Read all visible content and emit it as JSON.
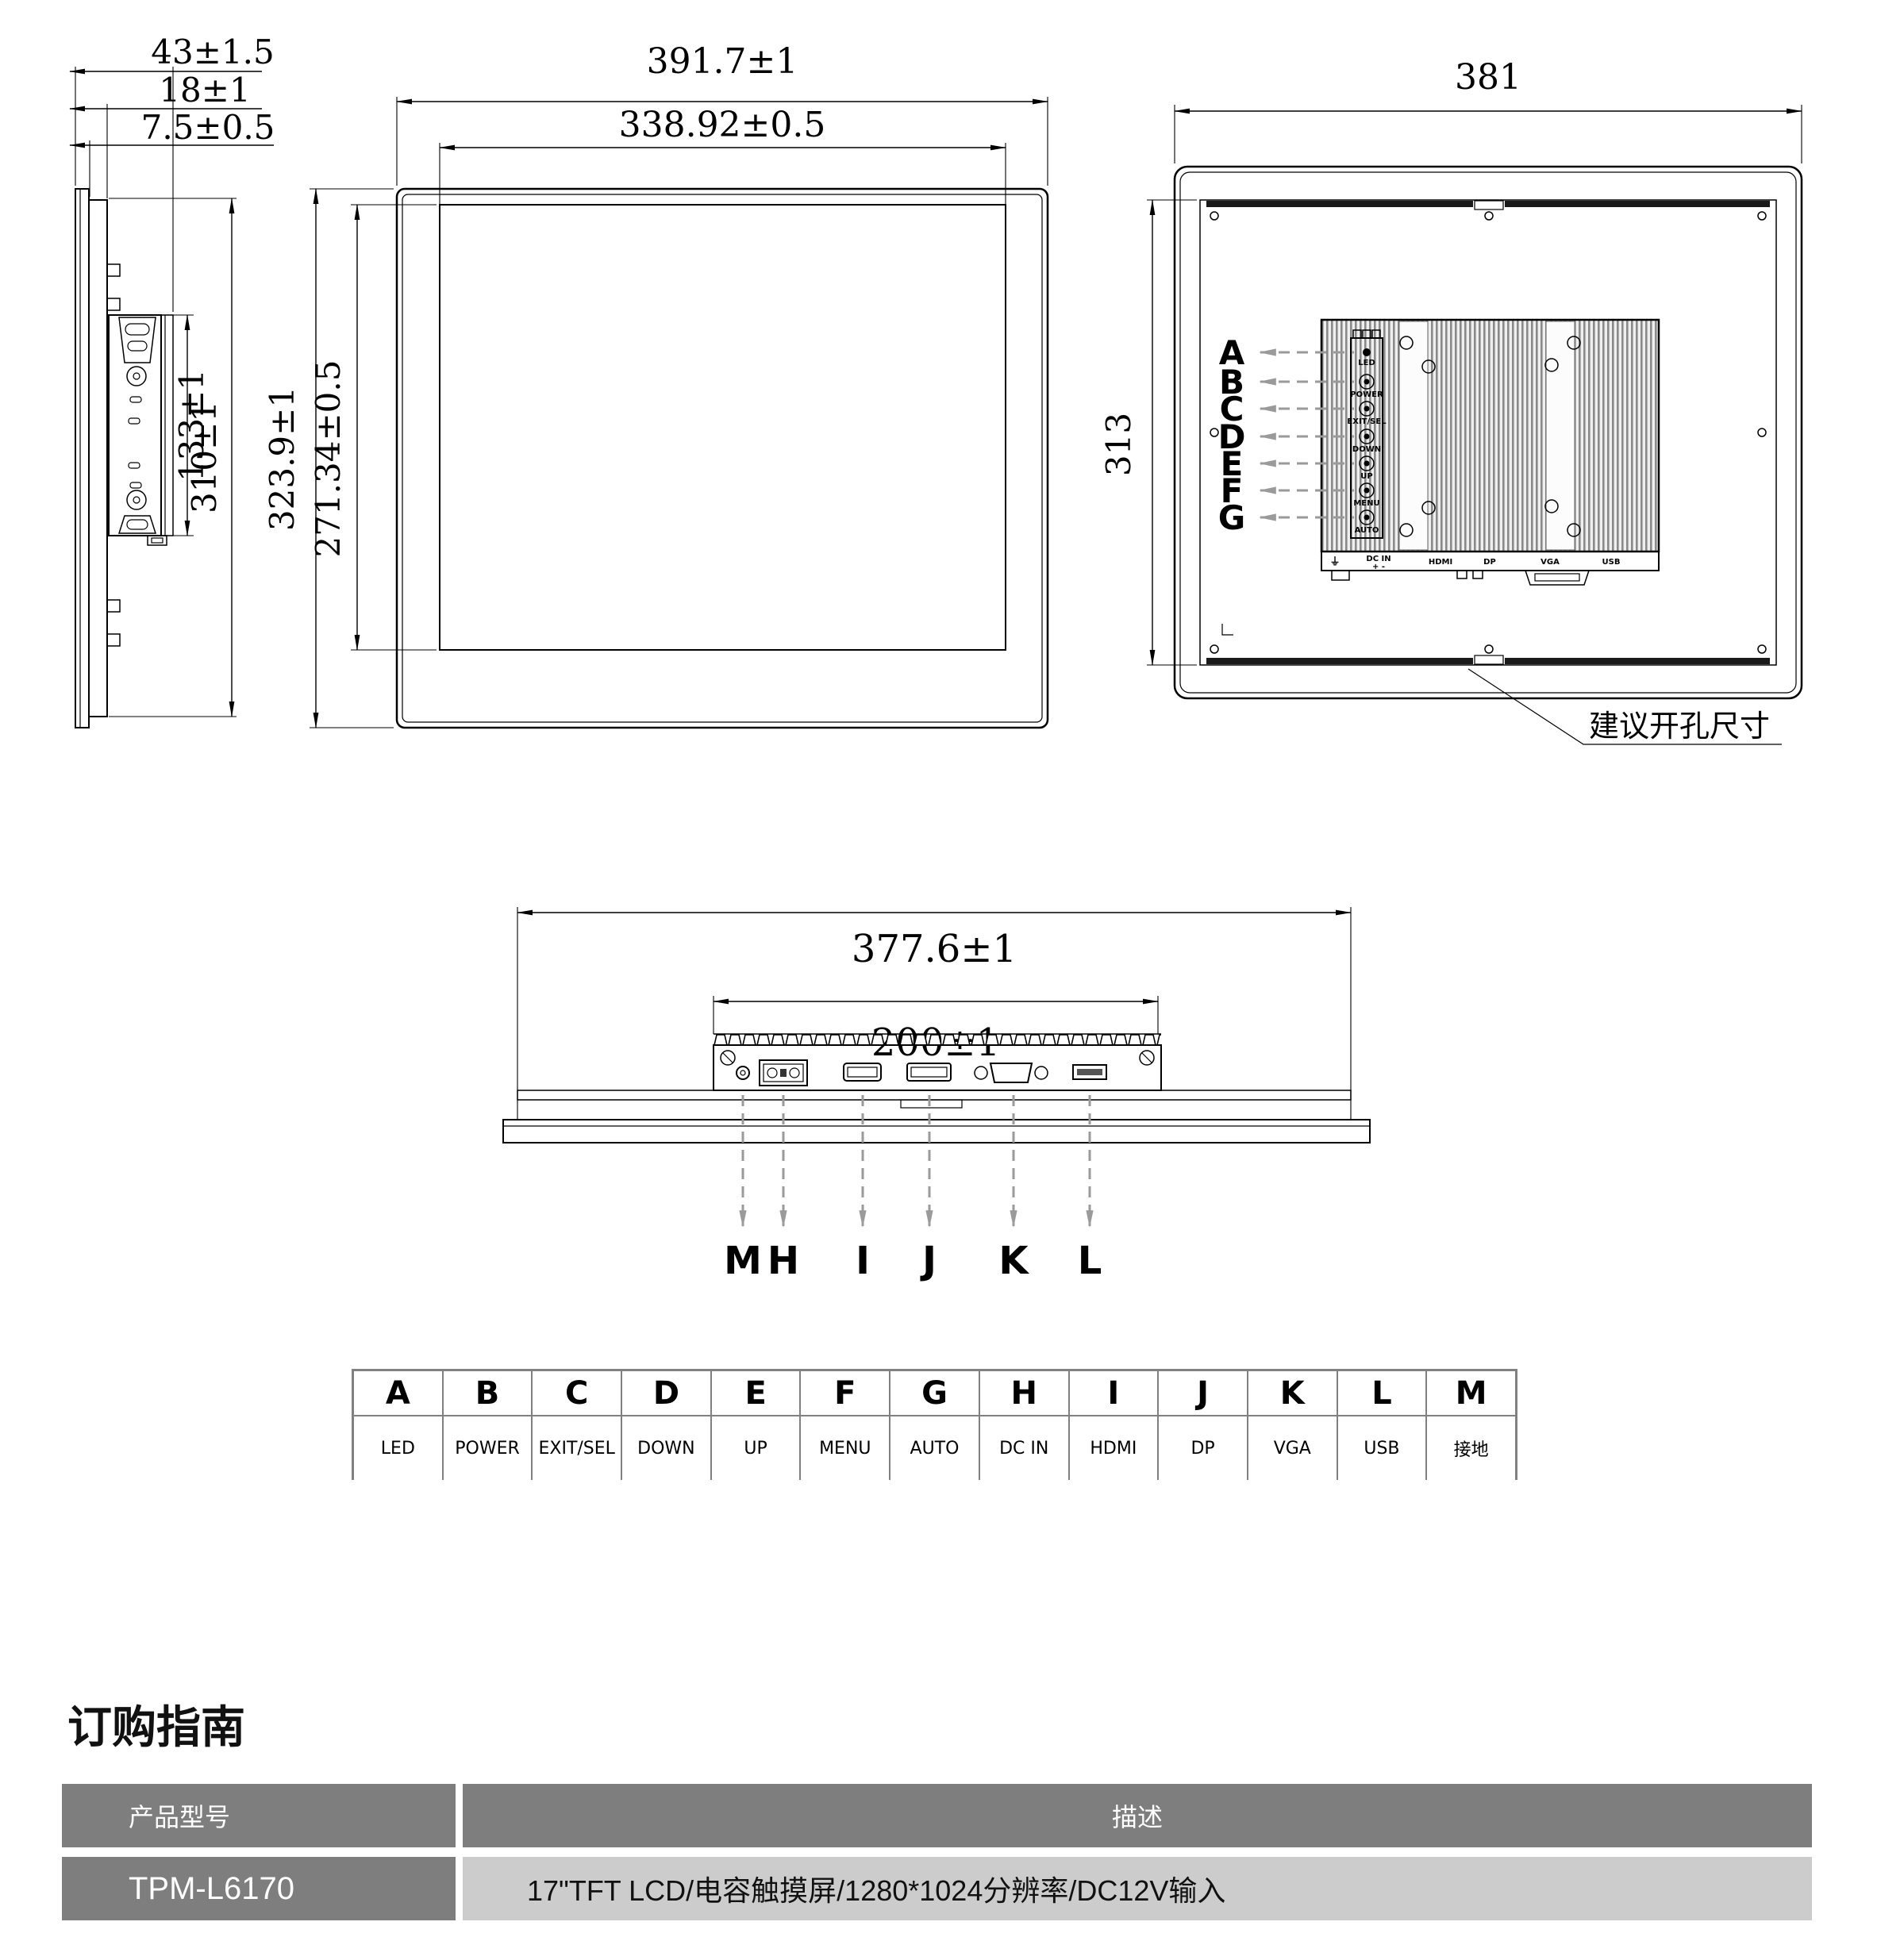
{
  "side_view": {
    "dim_depth_total": "43±1.5",
    "dim_depth_body": "18±1",
    "dim_depth_front": "7.5±0.5",
    "dim_module_height": "133±1",
    "dim_body_height": "310±1"
  },
  "front_view": {
    "dim_outer_width": "391.7±1",
    "dim_screen_width": "338.92±0.5",
    "dim_outer_height": "323.9±1",
    "dim_screen_height": "271.34±0.5"
  },
  "rear_view": {
    "dim_width": "381",
    "dim_height": "313",
    "cutout_note": "建议开孔尺寸",
    "callouts": [
      "A",
      "B",
      "C",
      "D",
      "E",
      "F",
      "G"
    ],
    "controls": [
      "LED",
      "POWER",
      "EXIT/SEL",
      "DOWN",
      "UP",
      "MENU",
      "AUTO"
    ],
    "ports": {
      "ground": "⏚",
      "dcin": "DC IN",
      "polarity": "+  -",
      "hdmi": "HDMI",
      "dp": "DP",
      "vga": "VGA",
      "usb": "USB"
    }
  },
  "bottom_view": {
    "dim_outer": "377.6±1",
    "dim_module": "200±1",
    "callouts": [
      "M",
      "H",
      "I",
      "J",
      "K",
      "L"
    ]
  },
  "legend": {
    "headers": [
      "A",
      "B",
      "C",
      "D",
      "E",
      "F",
      "G",
      "H",
      "I",
      "J",
      "K",
      "L",
      "M"
    ],
    "labels": [
      "LED",
      "POWER",
      "EXIT/SEL",
      "DOWN",
      "UP",
      "MENU",
      "AUTO",
      "DC IN",
      "HDMI",
      "DP",
      "VGA",
      "USB",
      "接地"
    ]
  },
  "ordering": {
    "heading": "订购指南",
    "col_model": "产品型号",
    "col_desc": "描述",
    "model": "TPM-L6170",
    "description": "17\"TFT LCD/电容触摸屏/1280*1024分辨率/DC12V输入"
  }
}
